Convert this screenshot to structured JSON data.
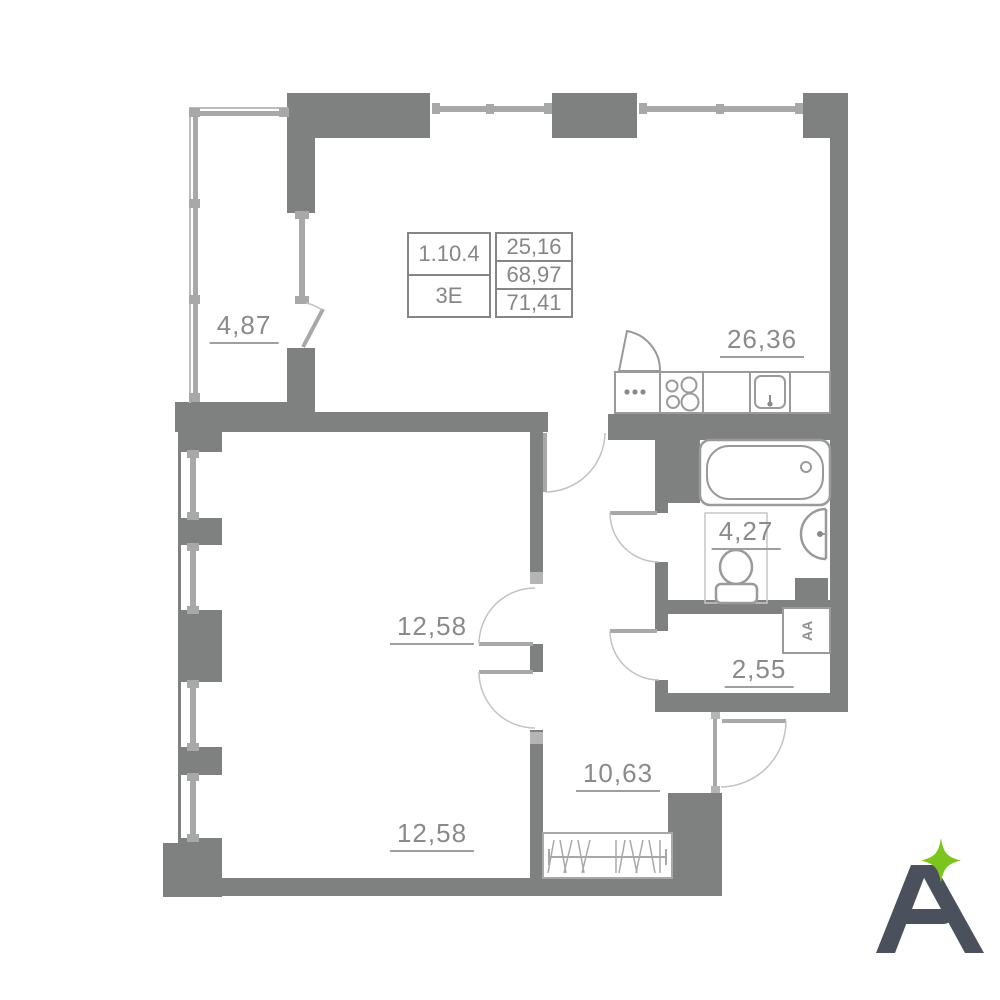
{
  "unit_card": {
    "unit_number": "1.10.4",
    "unit_type": "3Е",
    "areas": {
      "living": "25,16",
      "without_balcony": "68,97",
      "total": "71,41"
    }
  },
  "rooms": {
    "balcony": "4,87",
    "kitchen_living": "26,36",
    "bathroom": "4,27",
    "storage": "2,55",
    "hallway": "10,63",
    "bedroom_1": "12,58",
    "bedroom_2": "12,58"
  },
  "branding": {
    "logo_letter": "A",
    "logo_color": "#4b515c",
    "star_color": "#7cc51d"
  },
  "colors": {
    "wall": "#7f8080",
    "line": "#a8a8a8",
    "text": "#8a8a8a",
    "background": "#ffffff"
  }
}
